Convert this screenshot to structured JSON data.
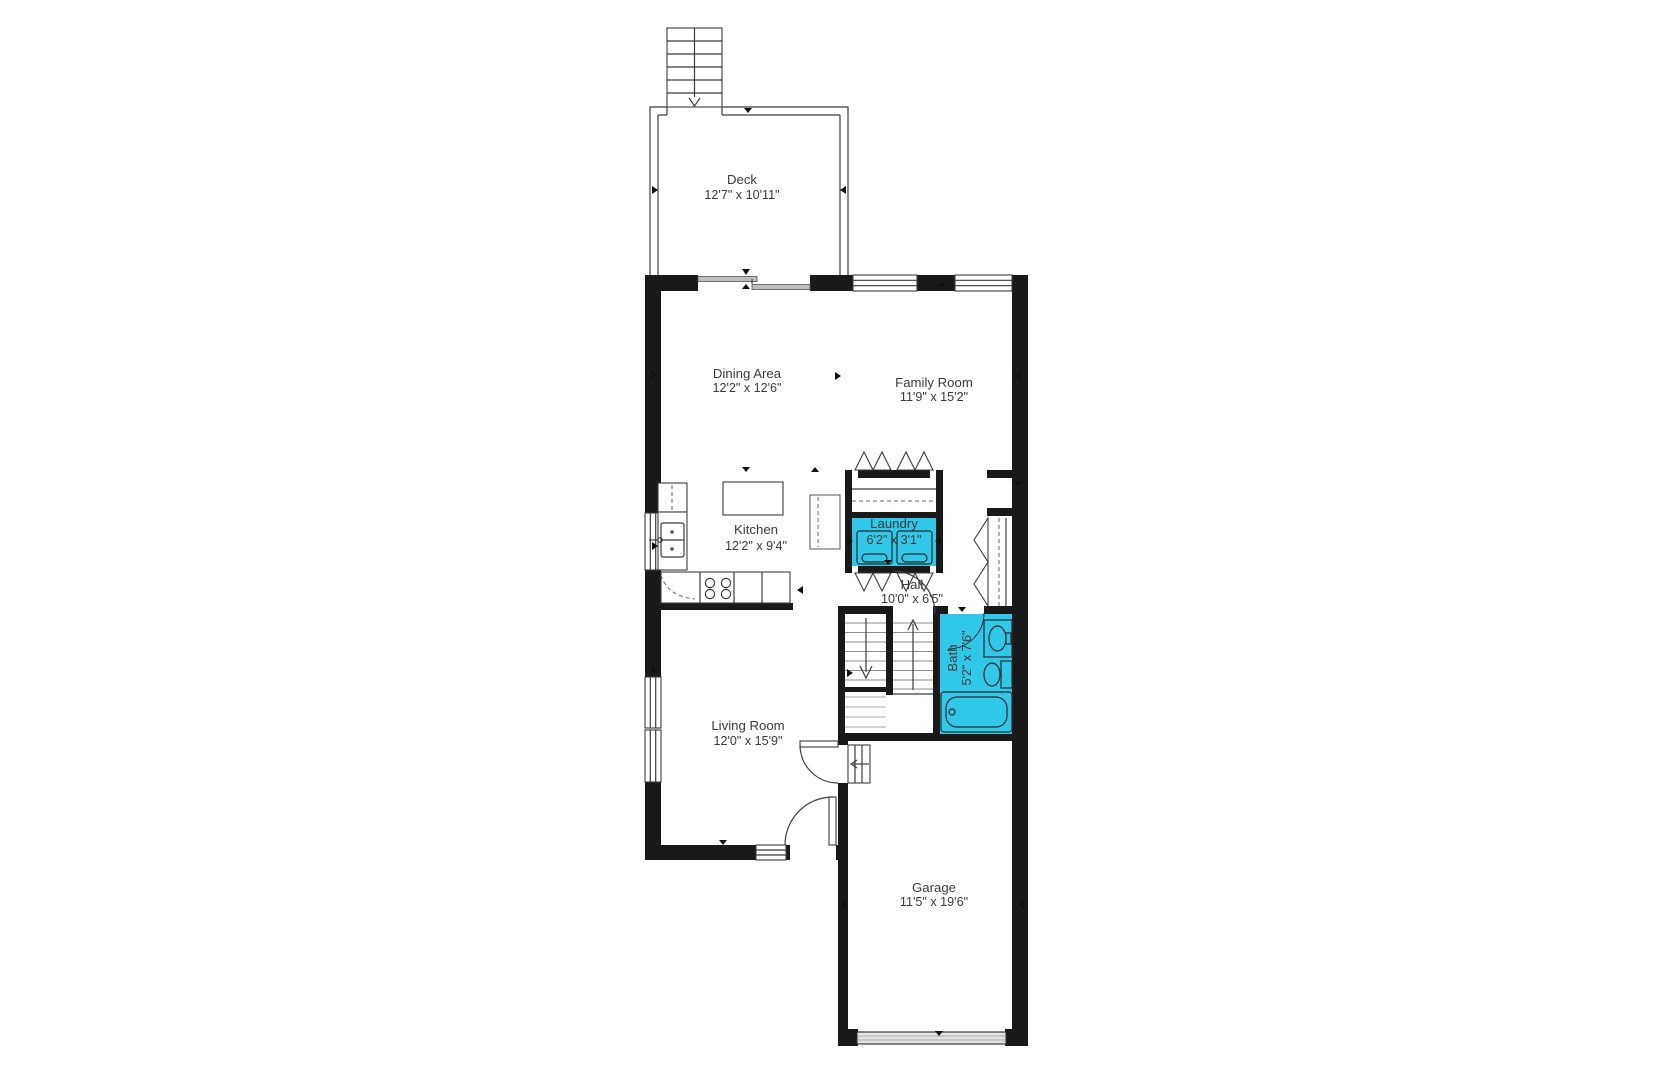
{
  "colors": {
    "wall": "#191919",
    "room_highlight": "#2FC8E8",
    "label_text": "#3a3a3a"
  },
  "rooms": {
    "deck": {
      "name": "Deck",
      "dims": "12'7\" x 10'11\""
    },
    "dining": {
      "name": "Dining Area",
      "dims": "12'2\" x 12'6\""
    },
    "family": {
      "name": "Family Room",
      "dims": "11'9\" x 15'2\""
    },
    "kitchen": {
      "name": "Kitchen",
      "dims": "12'2\" x 9'4\""
    },
    "laundry": {
      "name": "Laundry",
      "dims": "6'2\" x 3'1\""
    },
    "hall": {
      "name": "Hall",
      "dims": "10'0\" x 6'5\""
    },
    "bath": {
      "name": "Bath",
      "dims": "5'2\" x 7'6\""
    },
    "living": {
      "name": "Living Room",
      "dims": "12'0\" x 15'9\""
    },
    "garage": {
      "name": "Garage",
      "dims": "11'5\" x 19'6\""
    }
  }
}
